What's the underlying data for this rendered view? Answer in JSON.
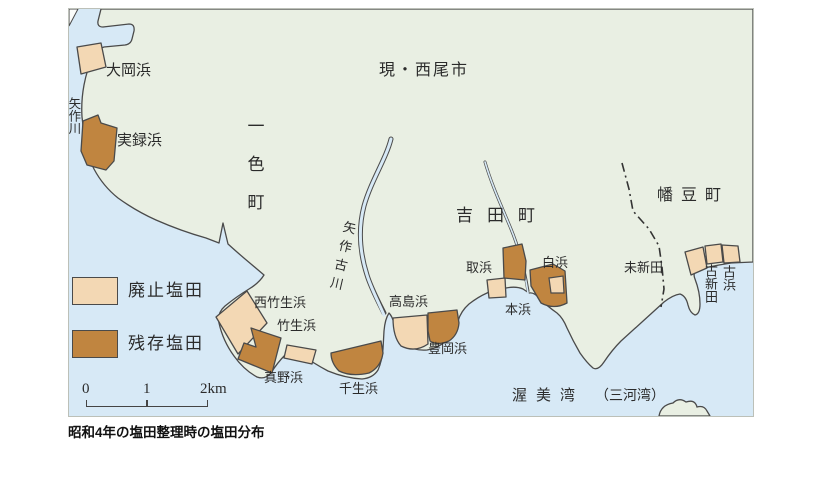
{
  "caption": "昭和4年の塩田整理時の塩田分布",
  "legend": {
    "abolished_label": "廃止塩田",
    "remaining_label": "残存塩田",
    "abolished_color": "#f3d8b4",
    "remaining_color": "#c08540"
  },
  "scale_bar": {
    "tick0": "0",
    "tick1": "1",
    "tick2": "2km"
  },
  "colors": {
    "sea": "#d7e9f6",
    "land": "#e9efe3",
    "outline": "#4a4a4a",
    "text": "#2b2b2b"
  },
  "regions": {
    "current_city": "現・西尾市",
    "isshiki_town": "一色町",
    "yoshida_town": "吉田町",
    "hazu_town": "幡豆町",
    "bay": "渥美湾",
    "bay_alt": "（三河湾）"
  },
  "rivers": {
    "yahagi": "矢作川",
    "yahagi_furukawa": "矢作古川"
  },
  "salt_fields": {
    "ogahama": "大岡浜",
    "jitsurokuhama": "実録浜",
    "nishitakeohama": "西竹生浜",
    "takeohama": "竹生浜",
    "manohama": "真野浜",
    "sennyuhama": "千生浜",
    "takashimahama": "高島浜",
    "toyookahama": "豊岡浜",
    "torihama": "取浜",
    "honhama": "本浜",
    "shirahama": "白浜",
    "miishinden": "未新田",
    "koshinden": "古新田",
    "kohama": "古浜"
  }
}
